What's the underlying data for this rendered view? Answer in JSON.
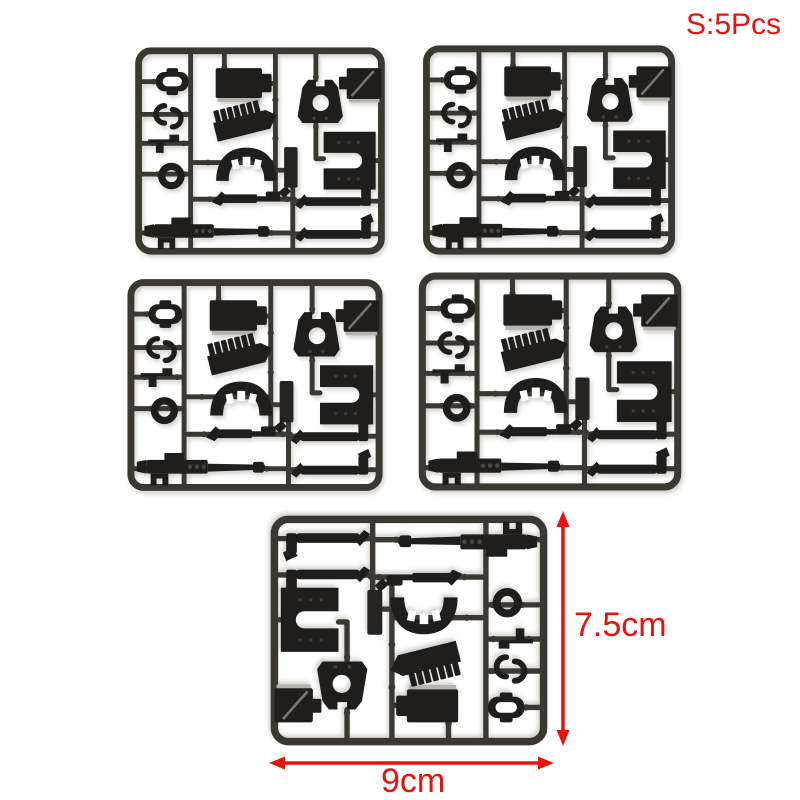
{
  "photo": {
    "badge_label": "S:5Pcs",
    "height_label": "7.5cm",
    "width_label": "9cm",
    "sprue_count": 5,
    "subject": "Black plastic model-kit part sprues (runners) on a white background",
    "colors": {
      "accent_red": "#e8130d",
      "plastic_part": "#201e1d",
      "plastic_frame": "#3b3834",
      "background": "#ffffff"
    },
    "sprues": [
      {
        "id": "sprue-1",
        "position": "top-left"
      },
      {
        "id": "sprue-2",
        "position": "top-right"
      },
      {
        "id": "sprue-3",
        "position": "middle-left"
      },
      {
        "id": "sprue-4",
        "position": "middle-right"
      },
      {
        "id": "sprue-5",
        "position": "bottom-center-rotated-180"
      }
    ],
    "parts_per_sprue": [
      "buckle-clip",
      "double-c-hook",
      "l-bracket",
      "ring",
      "backpack-block",
      "ribbed-magazine",
      "curved-waist-bridge",
      "brand-tag",
      "triangle-faceplate",
      "slotted-box",
      "u-channel-plate",
      "grip-linkage-rod",
      "rifle",
      "barrel-rod",
      "barrel-rod"
    ]
  }
}
